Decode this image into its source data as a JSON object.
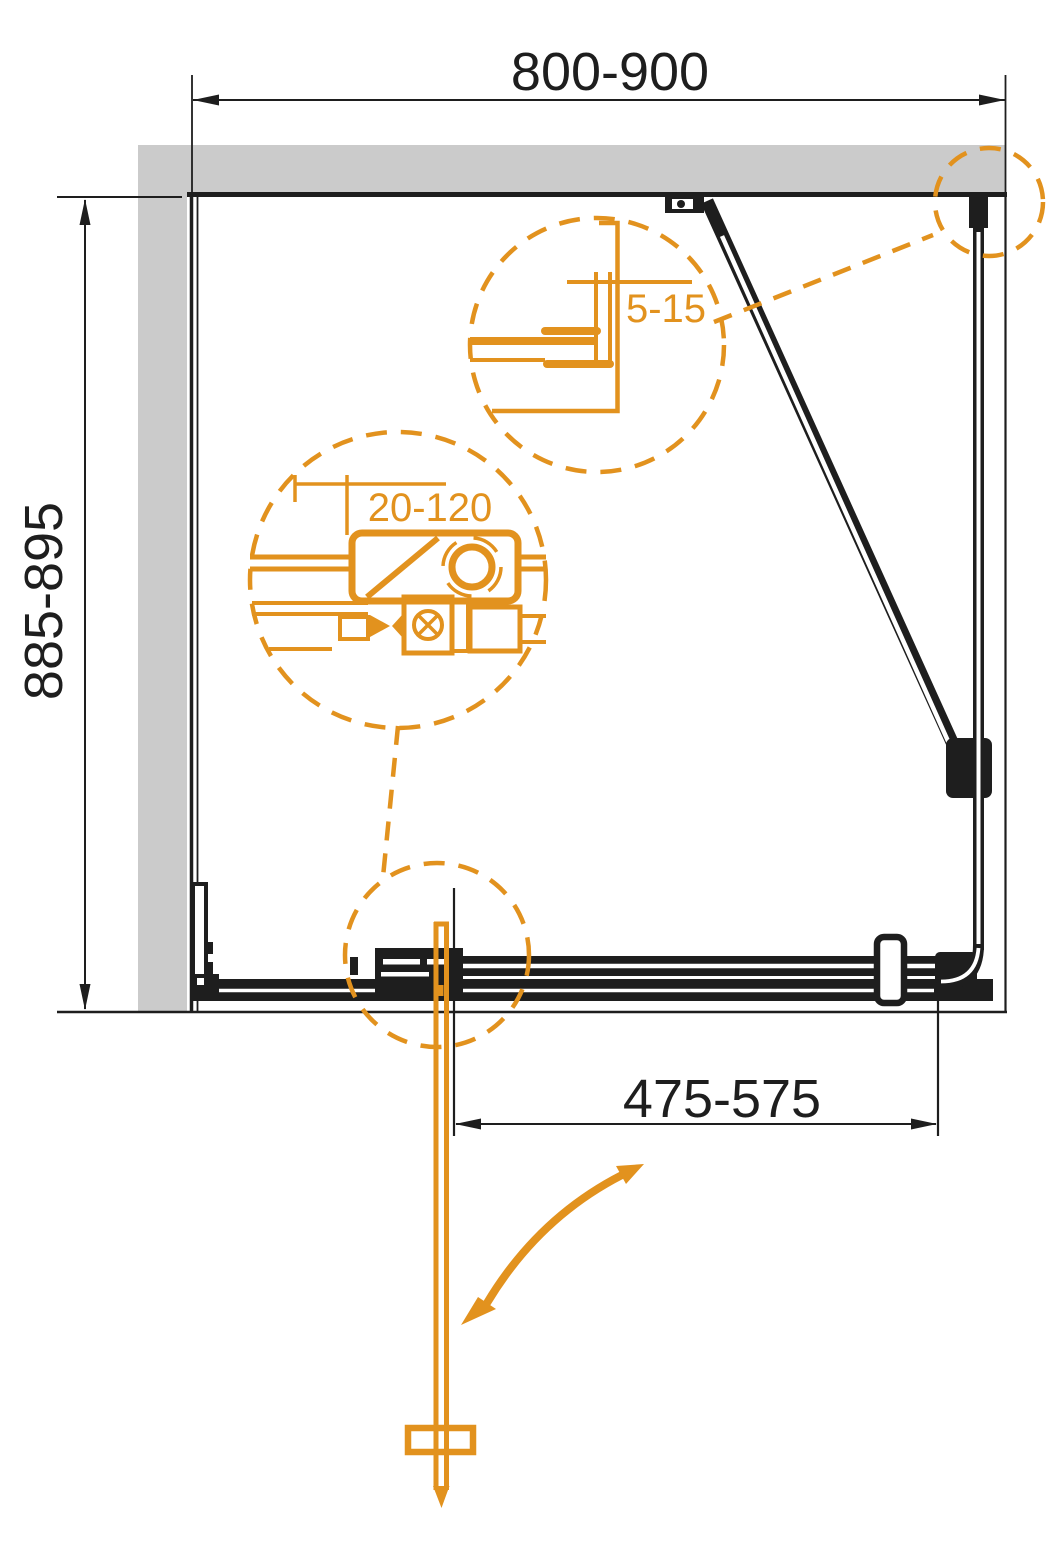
{
  "page": {
    "type": "technical-drawing",
    "subject": "shower-enclosure-plan-view"
  },
  "colors": {
    "accent_orange": "#E2921E",
    "wall_gray": "#CBCBCB",
    "line_black": "#1E1E1E",
    "background": "#FFFFFF"
  },
  "labels": {
    "width": "800-900",
    "depth": "885-895",
    "door_opening": "475-575",
    "detail_gap": "5-15",
    "detail_adjustment": "20-120"
  }
}
